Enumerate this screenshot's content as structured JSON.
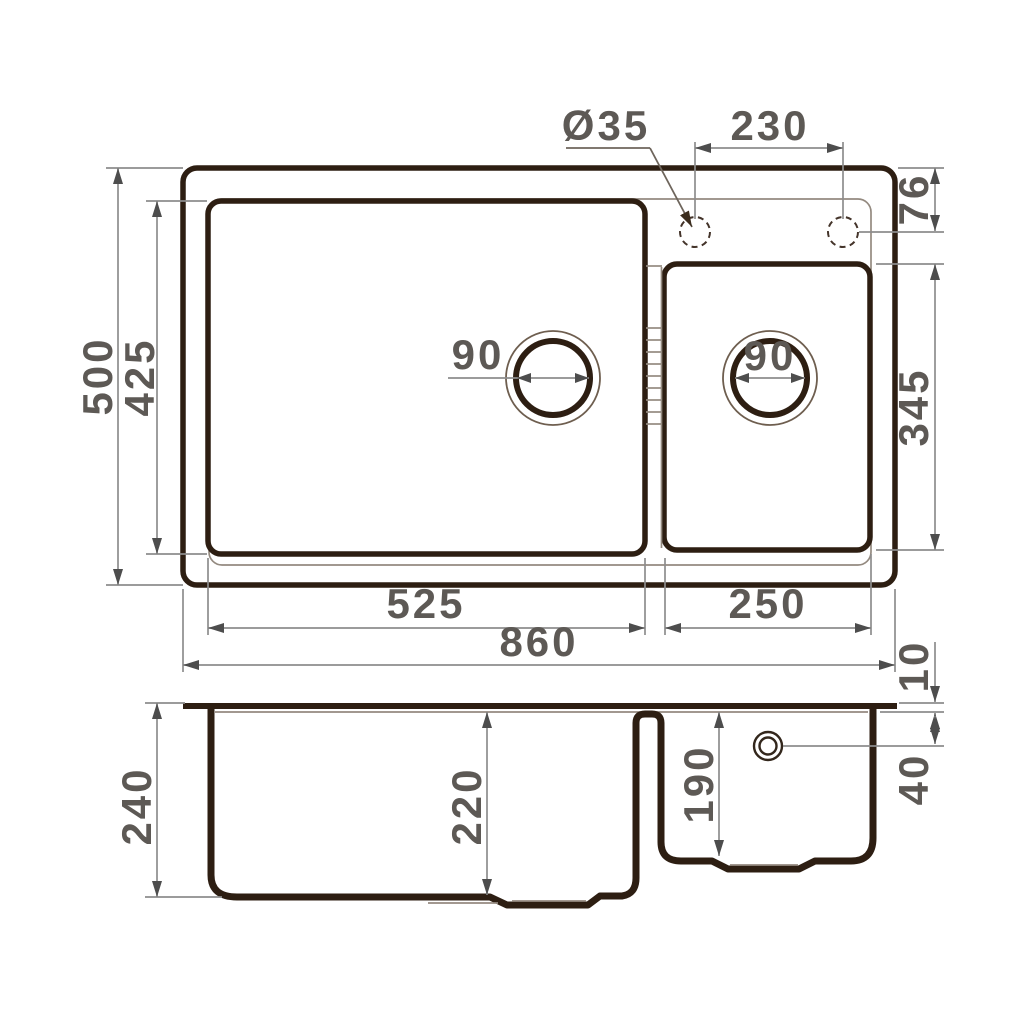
{
  "drawing": {
    "title": "Double-bowl kitchen sink dimensional drawing",
    "views": [
      "top view",
      "side section view"
    ],
    "units": "mm"
  },
  "dims": {
    "faucet_hole_diameter": "Ø35",
    "faucet_hole_spacing": "230",
    "faucet_hole_offset_top": "76",
    "overall_depth": "500",
    "main_bowl_inner_depth": "425",
    "main_drain_diameter": "90",
    "small_drain_diameter": "90",
    "small_bowl_inner_depth": "345",
    "main_bowl_inner_width": "525",
    "small_bowl_inner_width": "250",
    "overall_width": "860",
    "rim_thickness": "10",
    "overflow_offset": "40",
    "overall_height": "240",
    "main_bowl_height": "220",
    "small_bowl_height": "190"
  },
  "colors": {
    "outline_dark": "#2d1e12",
    "thin_line": "#948a80",
    "dimension_line": "#8d8d8d",
    "dimension_text": "#5d5955",
    "background": "#ffffff"
  }
}
